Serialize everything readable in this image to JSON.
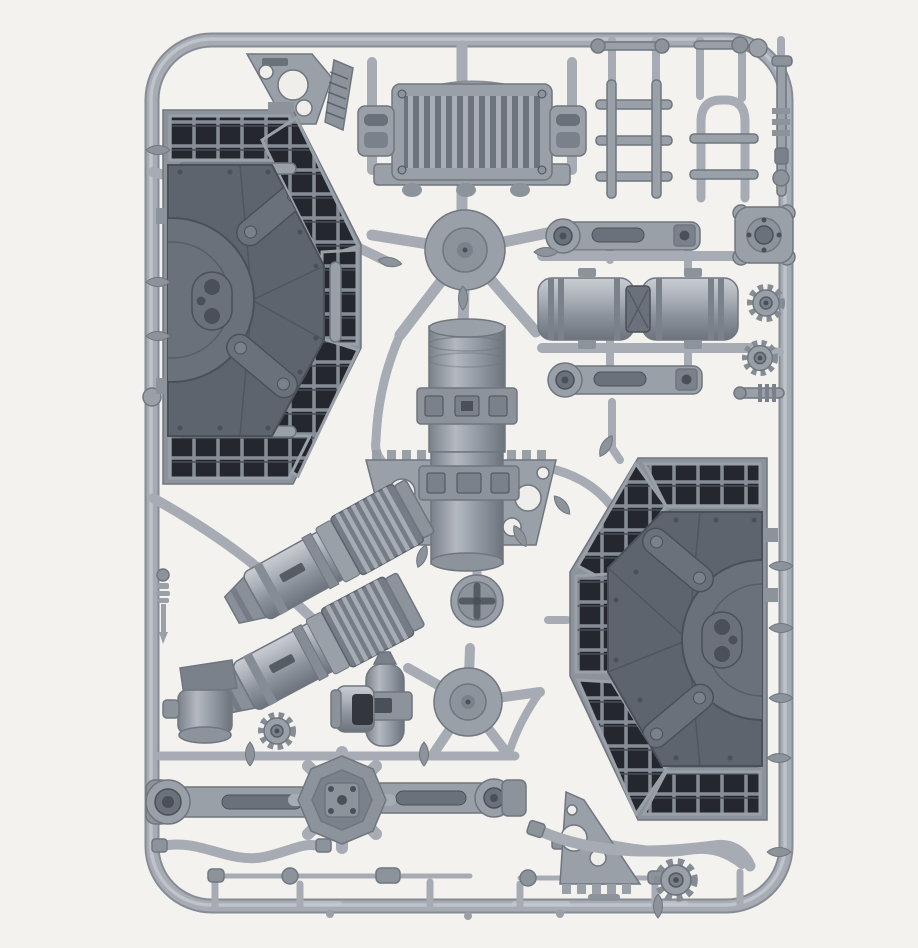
{
  "scene": {
    "type": "product-photo",
    "subject": "Grey plastic model sprue frame holding unassembled vehicle accessory parts on a white background",
    "background_color": "#f3f2ef"
  },
  "colors": {
    "bg": "#f3f2ef",
    "sprue": "#a7acb4",
    "sprue-hi": "#c6cad1",
    "sprue-lo": "#868c95",
    "part": "#9aa0a8",
    "part-mid": "#8d939b",
    "part-lo": "#7b818a",
    "panel": "#5e646d",
    "panel-hi": "#6b717a",
    "detail": "#4b5058",
    "grille": "#24272d",
    "grille-line": "#878d96",
    "edge": "#70767f",
    "hole": "#efeeeb"
  },
  "parts": [
    {
      "id": "sprue-frame",
      "label": "Rounded rectangular sprue frame"
    },
    {
      "id": "corner-bracket-top-left",
      "label": "Triangular gusset bracket with holes"
    },
    {
      "id": "radiator-assembly",
      "label": "Radiator grille with carry handle and clamps"
    },
    {
      "id": "ladder-pieces",
      "label": "Ladder and handrail sections"
    },
    {
      "id": "hatch-panel-left",
      "label": "Large octagonal hatch panel with vent grilles"
    },
    {
      "id": "hatch-panel-right",
      "label": "Large octagonal hatch panel with vent grilles (mirrored)"
    },
    {
      "id": "center-drum",
      "label": "Cylindrical drum with strap clamps"
    },
    {
      "id": "toothed-bracket",
      "label": "Toothed mounting bracket with lightening holes"
    },
    {
      "id": "engine-cylinder-a",
      "label": "Finned engine/exhaust cylinder"
    },
    {
      "id": "engine-cylinder-b",
      "label": "Finned engine/exhaust cylinder"
    },
    {
      "id": "cross-puck",
      "label": "Round cap with cross slot"
    },
    {
      "id": "injection-hub-upper",
      "label": "Sprue injection hub"
    },
    {
      "id": "injection-hub-lower",
      "label": "Sprue injection hub"
    },
    {
      "id": "pump-capsule",
      "label": "Small pump body with clamp"
    },
    {
      "id": "sleeve-cylinder",
      "label": "Open cylinder sleeve"
    },
    {
      "id": "gear-small",
      "label": "Small gear wheel"
    },
    {
      "id": "cap-piece",
      "label": "Valve cap block"
    },
    {
      "id": "baluster-rod",
      "label": "Small turned rod"
    },
    {
      "id": "axle-assembly",
      "label": "Axle with central differential housing"
    },
    {
      "id": "hose-left",
      "label": "Curved hose"
    },
    {
      "id": "hose-right",
      "label": "Curved hose"
    },
    {
      "id": "linkage-rods",
      "label": "Thin linkage rods with couplers"
    },
    {
      "id": "corner-bracket-bottom-right",
      "label": "Triangular gusset bracket with holes (mirrored)"
    },
    {
      "id": "gear-bottom",
      "label": "Gear wheel"
    },
    {
      "id": "link-arm-top",
      "label": "Suspension link arm"
    },
    {
      "id": "link-arm-bottom",
      "label": "Suspension link arm"
    },
    {
      "id": "axle-drums",
      "label": "Twin ribbed drum coupling"
    },
    {
      "id": "hub-plate",
      "label": "Four-lobed hub plate"
    },
    {
      "id": "gear-right-1",
      "label": "Gear wheel"
    },
    {
      "id": "gear-right-2",
      "label": "Gear wheel"
    },
    {
      "id": "ribbed-rod",
      "label": "Ribbed connector rod"
    },
    {
      "id": "panel-hose",
      "label": "Curved hose under right panel"
    }
  ]
}
